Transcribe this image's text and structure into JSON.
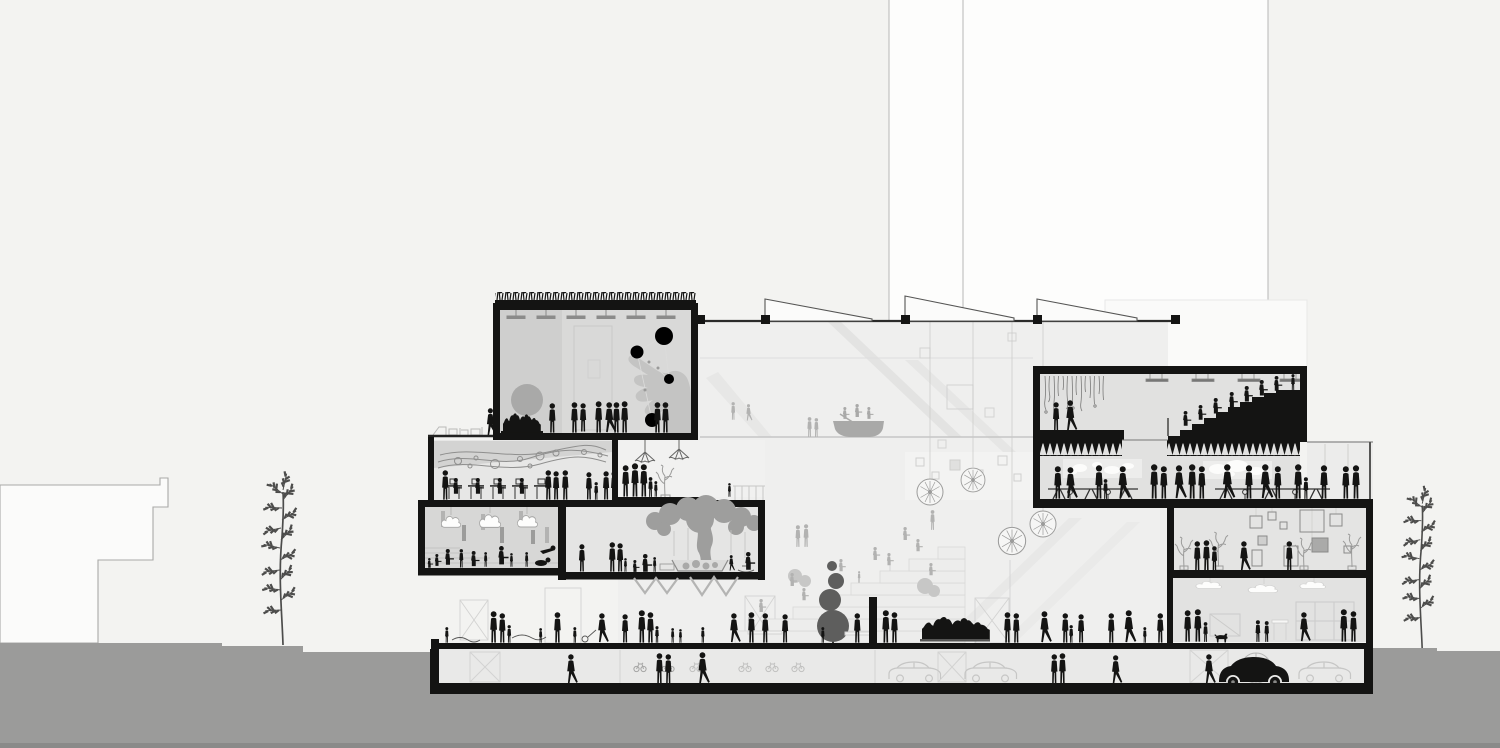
{
  "canvas": {
    "width": 1500,
    "height": 748
  },
  "scene": {
    "subject": "Black-and-white architectural section of a multi-storey cultural building with central atrium, populated with silhouette figures, context buildings, two trees, street level and basement parking",
    "levels": [
      {
        "name": "green-roof-media-room",
        "features": [
          "planted sedum roof",
          "projection wall with pointing-hand mural and white circles",
          "grey sphere exhibit",
          "seated audience",
          "ceiling lights"
        ]
      },
      {
        "name": "roof-terrace",
        "features": [
          "loungers",
          "tables",
          "walking visitor"
        ]
      },
      {
        "name": "library-workspace",
        "features": [
          "kinetic wire-and-ball ceiling artwork",
          "desks with monitors",
          "standing visitors"
        ]
      },
      {
        "name": "children-room",
        "features": [
          "white cloud lamps",
          "acoustic baffles",
          "shallow play steps",
          "children sitting and crawling"
        ]
      },
      {
        "name": "play-room",
        "features": [
          "indoor tree sculpture with hanging strings",
          "sand basin",
          "rocking toy",
          "parents and children"
        ]
      },
      {
        "name": "mezzanine",
        "features": [
          "wireframe pendant lamps",
          "family group",
          "potted plant",
          "play frame"
        ]
      },
      {
        "name": "atrium",
        "features": [
          "sawtooth skylights",
          "escalator diagonals",
          "dandelion pendant lights",
          "boat exhibit with rowers",
          "forum steps with seated figures",
          "dark topiary tree",
          "exhibit wall with small frames"
        ]
      },
      {
        "name": "auditorium",
        "features": [
          "stage with hanging scrim",
          "two performers",
          "black tiered seating with audience",
          "acoustic sawtooth soffit",
          "ceiling light bars"
        ]
      },
      {
        "name": "restaurant",
        "features": [
          "two glowing wall panels",
          "long communal tables with stools",
          "many standing guests"
        ]
      },
      {
        "name": "gallery",
        "features": [
          "hung picture frames",
          "wireframe plants",
          "visitors"
        ]
      },
      {
        "name": "cafe",
        "features": [
          "wavy cloud lights",
          "family with dog",
          "children",
          "shelf wall"
        ]
      },
      {
        "name": "street-level",
        "features": [
          "ground slab with foundation pads",
          "pedestrians",
          "crowded bench",
          "stroller"
        ]
      },
      {
        "name": "basement-parking",
        "features": [
          "outlined cars",
          "black car",
          "bicycle racks",
          "spoked wheel",
          "pedestrians",
          "cross-braced crates"
        ]
      }
    ],
    "context": {
      "left_stepped_building": 1,
      "background_white_towers": 2,
      "street_trees": 2
    },
    "figures_estimate": 120
  },
  "colors": {
    "ink": "#141413",
    "paper": "#f3f3f1",
    "bldgWhite": "#fdfdfc",
    "lineGray": "#b7b7b6",
    "faintLine": "#d3d3d2",
    "ground": "#9b9b9a",
    "groundDark": "#8a8a89",
    "roomMedia": "#d9d9d8",
    "roomPanel": "#cfcfce",
    "roomLib": "#e7e7e6",
    "roomKids": "#d7d7d6",
    "roomTree": "#e5e5e4",
    "roomAud": "#e1e1e0",
    "roomGal": "#e4e4e3",
    "roomCafe": "#e2e2e1",
    "basement": "#e9e9e8",
    "atrium": "#efefee",
    "band": "#e3e3e2",
    "stepFill": "#ededec",
    "stepLine": "#d9d9d8",
    "figGray": "#b2b2b1",
    "softGray": "#c7c7c6",
    "midGray": "#9e9e9d",
    "darkGray": "#5e5e5d",
    "hand": "#c4c4c3",
    "sphere": "#a9a9a8",
    "cloud": "#fdfdfc",
    "glow": "#ededec",
    "treeInk": "#4c4c4b",
    "carLine": "#c6c6c5",
    "wire": "#9c9c9b",
    "scrim": "#7a7a79"
  }
}
